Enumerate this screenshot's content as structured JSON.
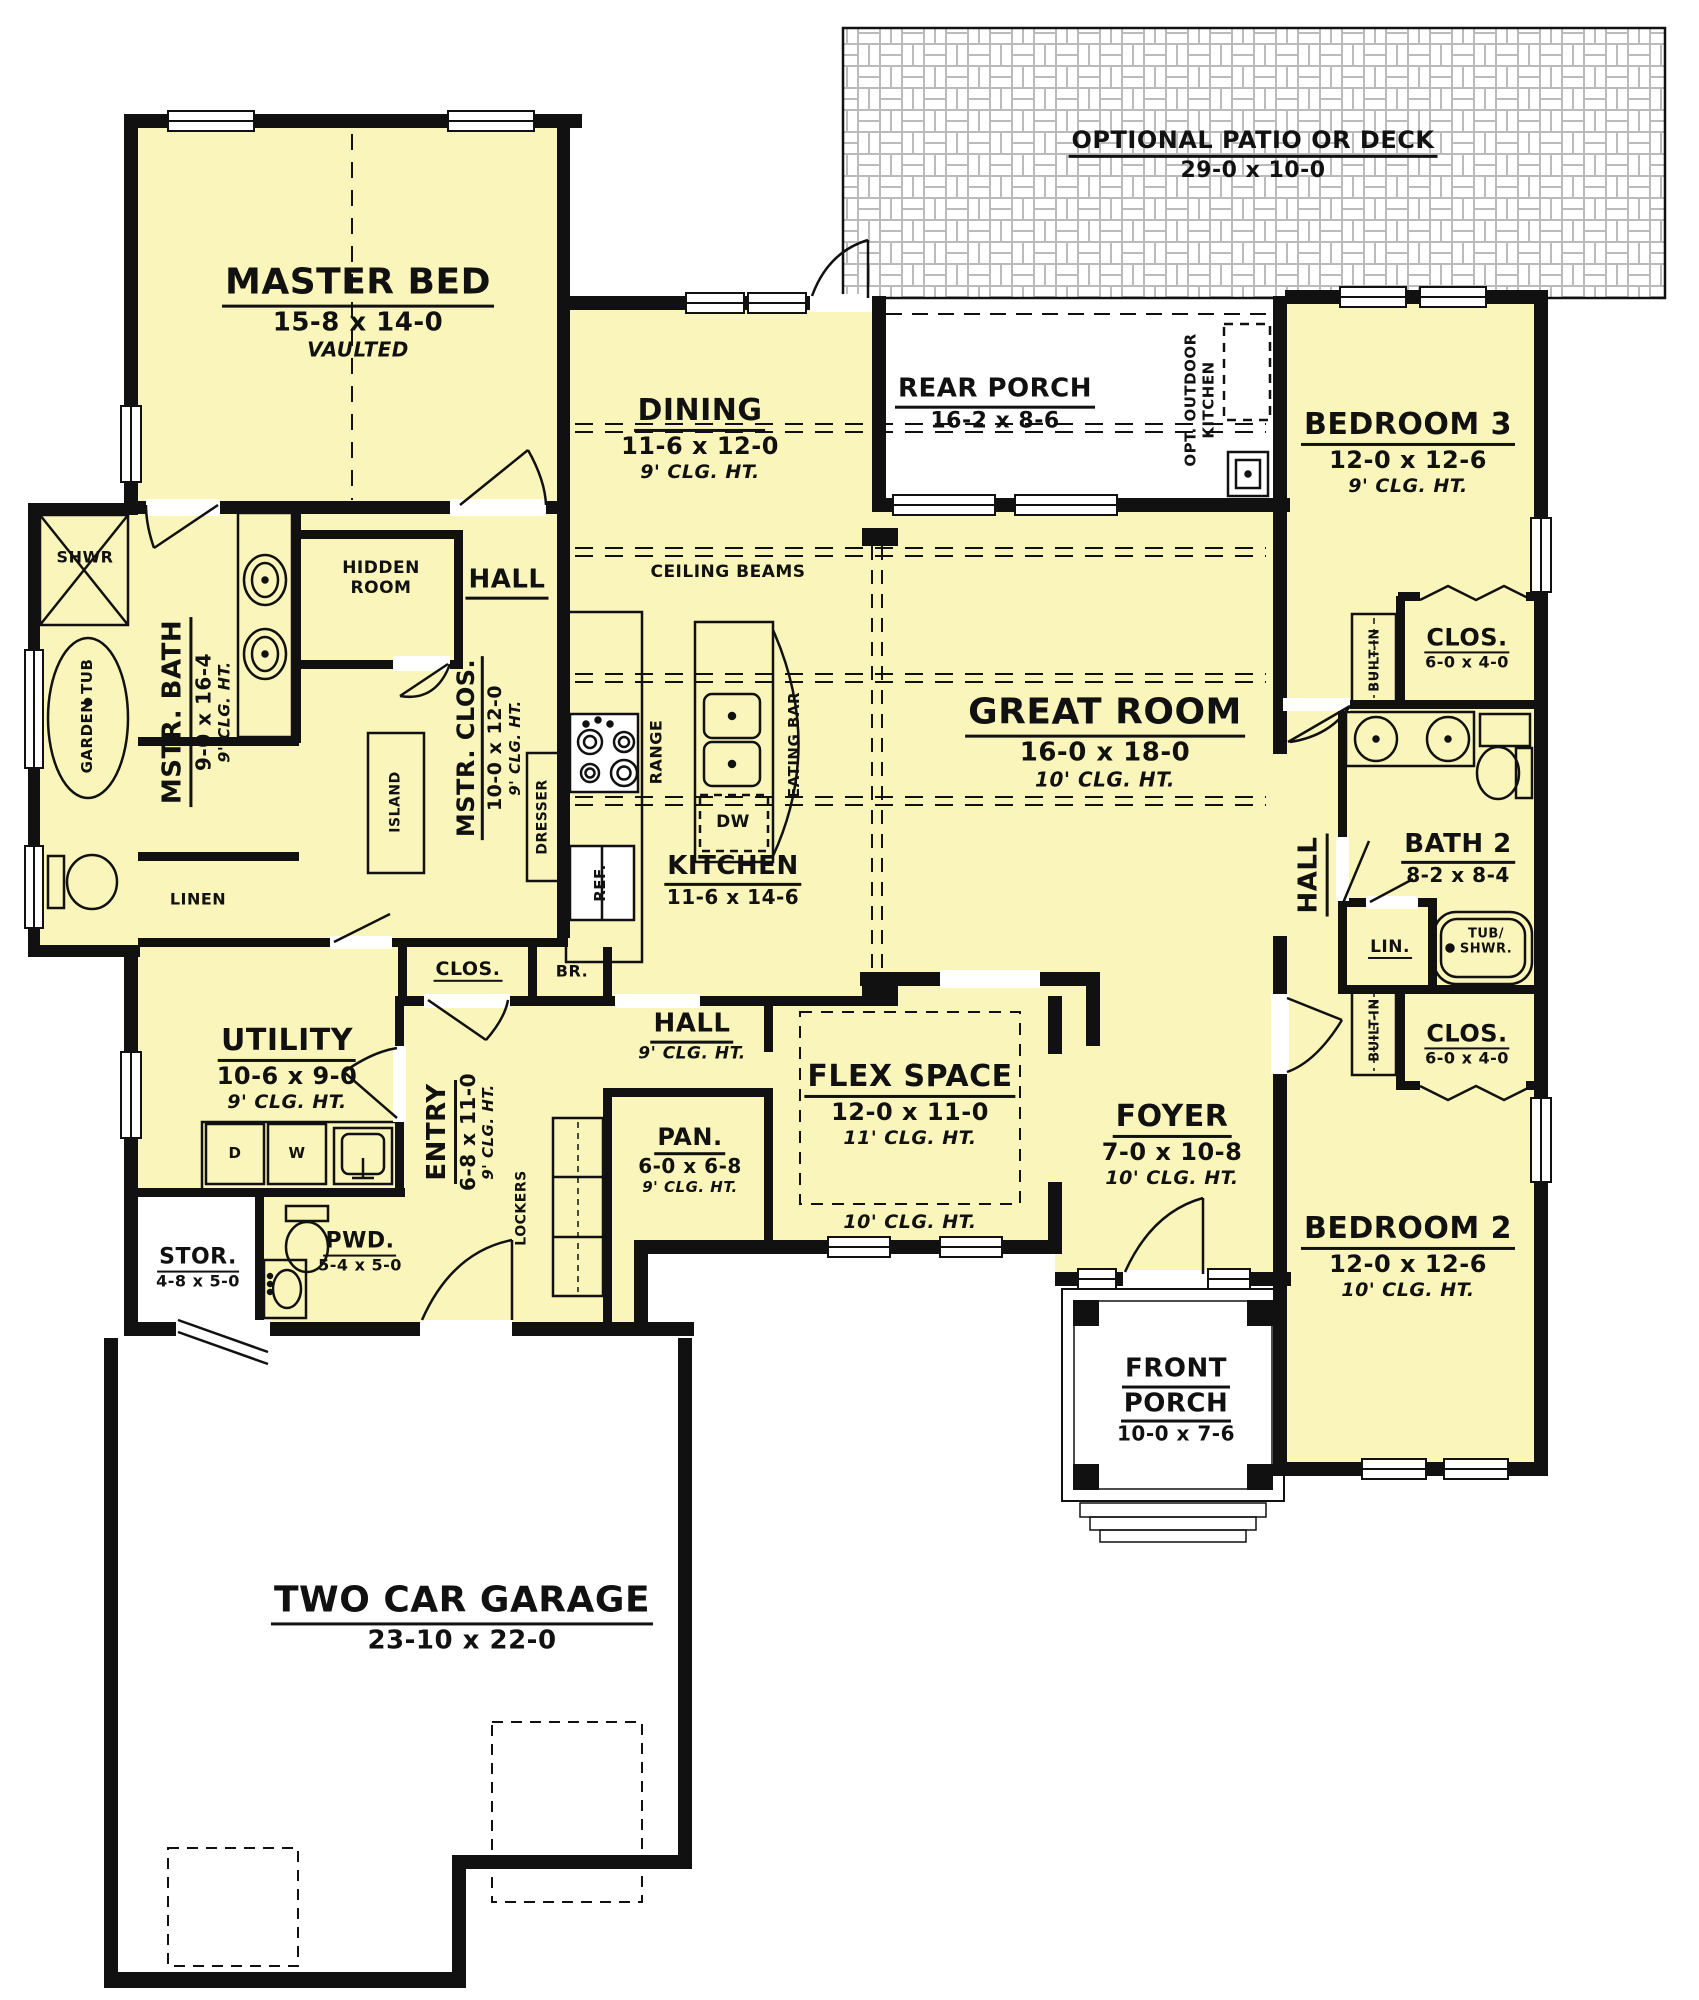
{
  "rooms": {
    "patio": {
      "name": "OPTIONAL PATIO OR DECK",
      "dim": "29-0 x 10-0"
    },
    "rear_porch": {
      "name": "REAR PORCH",
      "dim": "16-2 x 8-6"
    },
    "outdoor_kitchen": {
      "line1": "OPT. OUTDOOR",
      "line2": "KITCHEN"
    },
    "master": {
      "name": "MASTER BED",
      "dim": "15-8 x 14-0",
      "note": "VAULTED"
    },
    "dining": {
      "name": "DINING",
      "dim": "11-6 x 12-0",
      "clg": "9' CLG. HT."
    },
    "bed3": {
      "name": "BEDROOM 3",
      "dim": "12-0 x 12-6",
      "clg": "9' CLG. HT."
    },
    "great": {
      "name": "GREAT ROOM",
      "dim": "16-0 x 18-0",
      "clg": "10' CLG. HT."
    },
    "kitchen": {
      "name": "KITCHEN",
      "dim": "11-6 x 14-6"
    },
    "mstr_bath": {
      "name": "MSTR. BATH",
      "dim": "9-0 x 16-4",
      "clg": "9' CLG. HT."
    },
    "mstr_clos": {
      "name": "MSTR. CLOS.",
      "dim": "10-0 x 12-0",
      "clg": "9' CLG. HT."
    },
    "hidden": {
      "line1": "HIDDEN",
      "line2": "ROOM"
    },
    "hall_left": {
      "name": "HALL"
    },
    "hall_center": {
      "name": "HALL",
      "clg": "9' CLG. HT."
    },
    "hall_right": {
      "name": "HALL"
    },
    "utility": {
      "name": "UTILITY",
      "dim": "10-6 x 9-0",
      "clg": "9' CLG. HT."
    },
    "entry": {
      "name": "ENTRY",
      "dim": "6-8 x 11-0",
      "clg": "9' CLG. HT."
    },
    "pan": {
      "name": "PAN.",
      "dim": "6-0 x 6-8",
      "clg": "9' CLG. HT."
    },
    "flex": {
      "name": "FLEX SPACE",
      "dim": "12-0 x 11-0",
      "clg": "11' CLG. HT.",
      "clg2": "10' CLG. HT."
    },
    "foyer": {
      "name": "FOYER",
      "dim": "7-0 x 10-8",
      "clg": "10' CLG. HT."
    },
    "front_porch": {
      "line1": "FRONT",
      "line2": "PORCH",
      "dim": "10-0 x 7-6"
    },
    "bed2": {
      "name": "BEDROOM 2",
      "dim": "12-0 x 12-6",
      "clg": "10' CLG. HT."
    },
    "bath2": {
      "name": "BATH 2",
      "dim": "8-2 x 8-4"
    },
    "clos3": {
      "name": "CLOS.",
      "dim": "6-0 x 4-0"
    },
    "clos2": {
      "name": "CLOS.",
      "dim": "6-0 x 4-0"
    },
    "clos_entry": {
      "name": "CLOS."
    },
    "stor": {
      "name": "STOR.",
      "dim": "4-8 x 5-0"
    },
    "pwd": {
      "name": "PWD.",
      "dim": "5-4 x 5-0"
    },
    "garage": {
      "name": "TWO CAR GARAGE",
      "dim": "23-10 x 22-0"
    }
  },
  "fixtures": {
    "shwr": "SHWR",
    "garden_tub": "GARDEN TUB",
    "linen": "LINEN",
    "lin": "LIN.",
    "tub_shwr1": "TUB/",
    "tub_shwr2": "SHWR.",
    "island": "ISLAND",
    "dresser": "DRESSER",
    "range": "RANGE",
    "eating_bar": "EATING BAR",
    "dw": "DW",
    "ref": "REF.",
    "br": "BR.",
    "lockers": "LOCKERS",
    "built_in": "BUILT-IN",
    "ceiling_beams": "CEILING BEAMS",
    "washer": "W",
    "dryer": "D"
  },
  "colors": {
    "floor": "#FAF6BB",
    "wall": "#111111",
    "paper": "#FFFFFF",
    "patio_line": "#BBBBBB"
  }
}
